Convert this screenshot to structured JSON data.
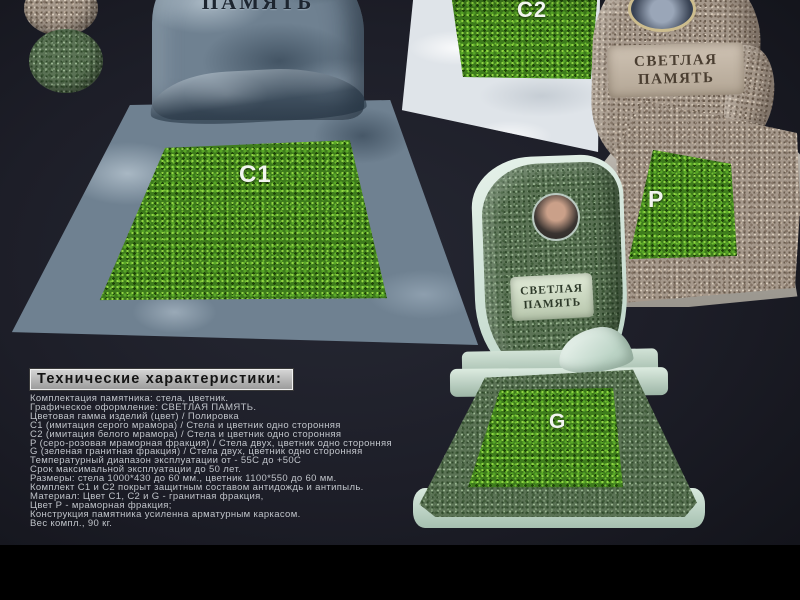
{
  "scene": {
    "background": "#1d1e28",
    "letterbox_color": "#000000",
    "accent_grass_green": "#3e7c1c",
    "marble_gray": "#6f8191",
    "marble_white": "#dfe4e9",
    "granite_pink": "#a5988b",
    "granite_green": "#5b7355"
  },
  "monuments": {
    "c1": {
      "label": "C1",
      "engraving": "ПАМЯТЬ"
    },
    "c2": {
      "label": "C2"
    },
    "p": {
      "label": "P",
      "engraving_line1": "СВЕТЛАЯ",
      "engraving_line2": "ПАМЯТЬ"
    },
    "g": {
      "label": "G",
      "engraving_line1": "СВЕТЛАЯ",
      "engraving_line2": "ПАМЯТЬ"
    }
  },
  "swatches": [
    {
      "name": "marble-fraction-sample"
    },
    {
      "name": "granite-fraction-sample"
    }
  ],
  "specs": {
    "heading": "Технические характеристики:",
    "lines": [
      "Комплектация памятника: стела, цветник.",
      "Графическое оформление: СВЕТЛАЯ ПАМЯТЬ.",
      "Цветовая гамма изделий (цвет) / Полировка",
      "С1 (имитация серого мрамора) / Стела и цветник одно сторонняя",
      "С2 (имитация белого мрамора) / Стела и цветник одно сторонняя",
      "Р (серо-розовая мраморная фракция) / Стела двух, цветник одно сторонняя",
      "G (зеленая гранитная фракция) / Стела двух, цветник одно сторонняя",
      "Температурный диапазон эксплуатации от - 55С до +50С",
      "Срок максимальной эксплуатации до 50 лет.",
      "Размеры: стела 1000*430 до 60 мм., цветник 1100*550 до 60 мм.",
      "Комплект С1 и С2 покрыт защитным составом антидождь и антипыль.",
      "Материал: Цвет С1, С2 и G - гранитная фракция,",
      "Цвет Р - мраморная фракция;",
      "Конструкция памятника усиленна арматурным каркасом.",
      "Вес компл., 90 кг."
    ]
  }
}
